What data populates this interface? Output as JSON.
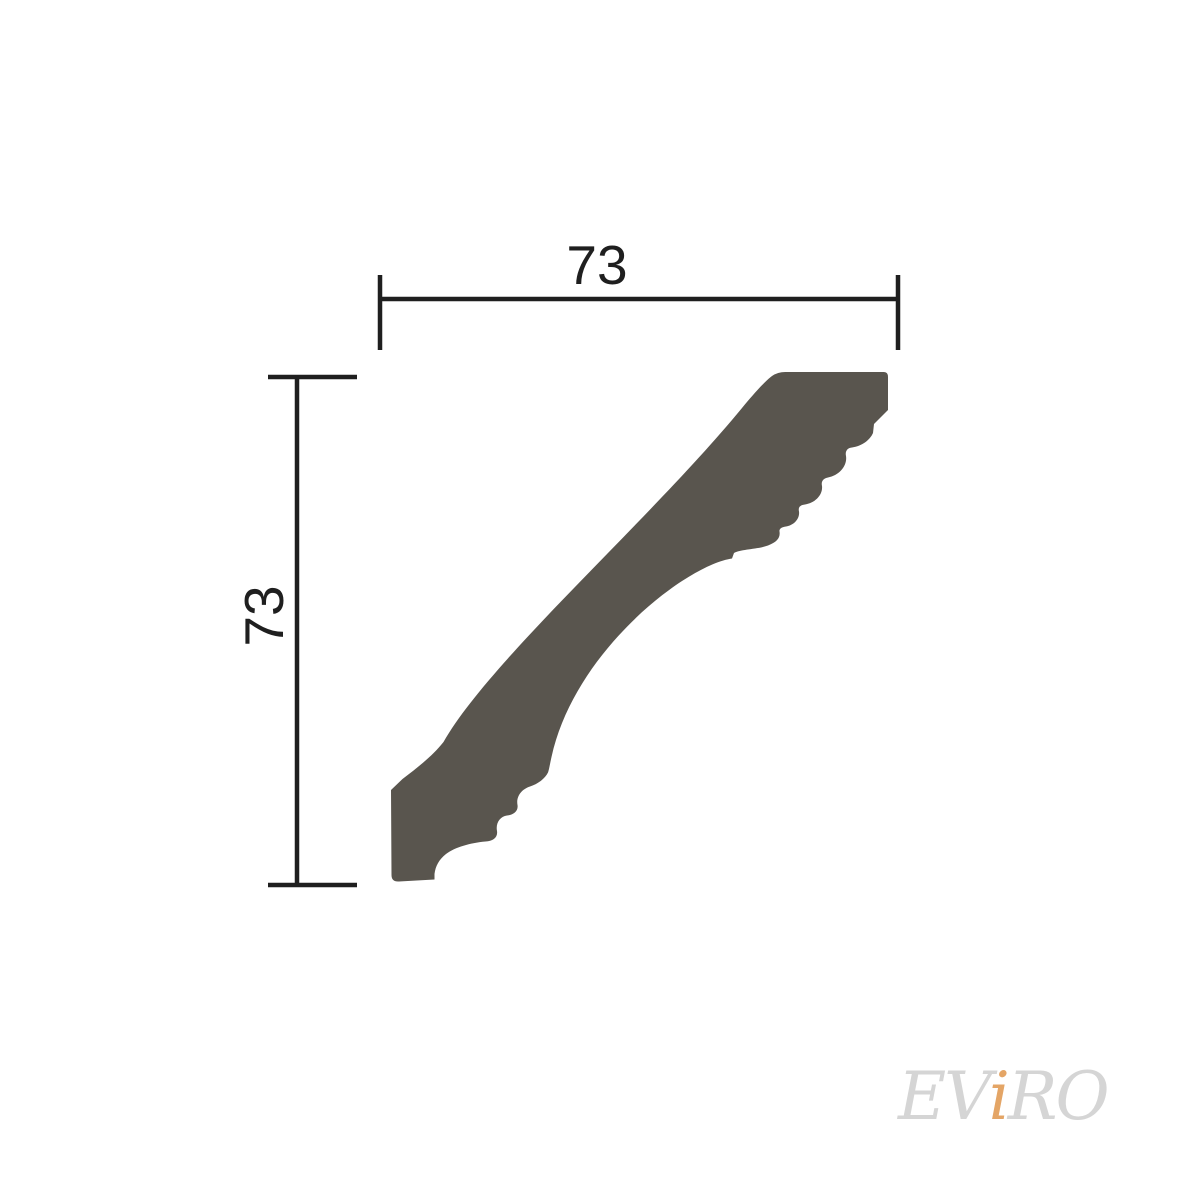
{
  "colors": {
    "background": "#ffffff",
    "line": "#1f1f1f",
    "shape_fill": "#59554e",
    "watermark_gray": "#d5d5d5",
    "watermark_accent": "#e4a566"
  },
  "diagram": {
    "shape_path": "M 786 372 L 884 372 Q 888 372 888 377 L 888 410 L 874 424 L 873 433 C 870 440 862 446 852 447.5 C 847 448 845 451.5 846 456 C 847.5 466 839 475.5 828 477.5 C 823 478.5 821 481.5 822 486 C 823 495 815 503 805 504.5 C 800 505 798 507.5 799 511.5 C 800 519 793.5 525.5 786 526.5 C 781.5 527 779 529 779.5 531.5 C 780.5 538 777 542 768 545.5 C 757 549.5 741 549 734 553 L 732 558.5 C 687 565 575 650 551.5 757 C 549.5 766 549 770 548 772.5 C 545 778.5 538 784 530 786.5 C 521 789.5 516 797 517.5 805 C 518.5 811 513.5 815 507 815.5 C 500 816.5 495.5 823 497 831 C 498 837.5 493 841 485.5 841.5 C 470 843 455.5 847 446 854 C 439 859.5 435.5 866 434.5 874 L 434.5 879.5 L 399 881.5 Q 391.5 882 391.5 875 L 391 790 L 402.5 779 C 417 768 432.5 756 443.5 742 C 490 660 650 520 742 408 C 752 396 764 382 772 376 Q 778 371.8 786 372 Z",
    "dimensions": {
      "width": {
        "label": "73"
      },
      "height": {
        "label": "73"
      }
    }
  },
  "watermark": {
    "part1": "EV",
    "part2": "i",
    "part3": "RO"
  }
}
